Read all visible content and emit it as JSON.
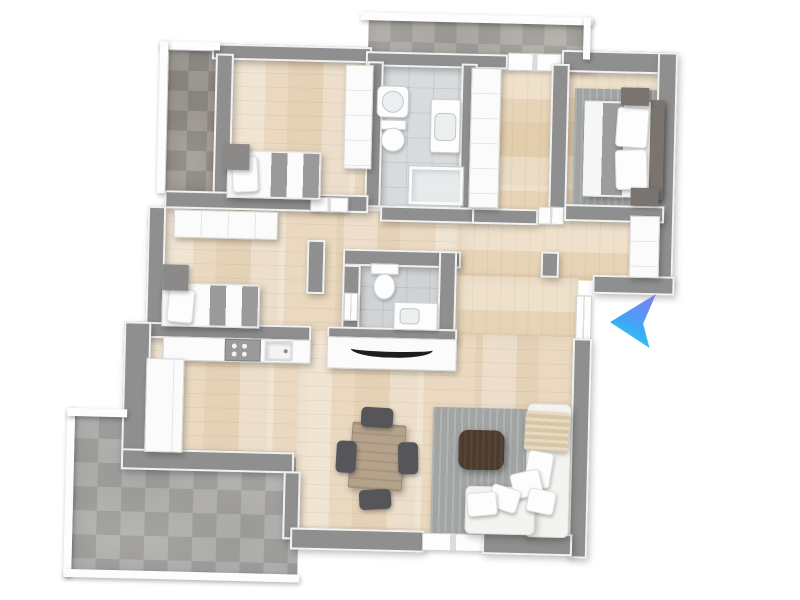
{
  "scene": {
    "type": "floor-plan-3d-top-view-render",
    "rotation_deg": 1.4,
    "rooms": [
      "bedroom-1",
      "bathroom",
      "closet-hall",
      "master-bedroom",
      "corridor",
      "bedroom-2",
      "wc",
      "kitchen",
      "dining-living-room",
      "entry-hall",
      "terrace",
      "balcony-top",
      "balcony-left"
    ],
    "marker": {
      "name": "entrance-arrow",
      "direction": "left",
      "style": "blue-gradient-paper-plane"
    }
  },
  "palette": {
    "bg": "#ffffff",
    "wall": "#8f8f8f",
    "wood": "#ead9c0",
    "wood2": "#e7d4b6",
    "tile": "#d8dbdd",
    "tile2": "#d0d3d5",
    "stone": "#b1b0ae",
    "stonedk": "#a49e98",
    "stonemd": "#b3b0ab",
    "rug": "#a0a4a2",
    "cube": "#8b8a88",
    "tablewood": "#b4a28b",
    "chair": "#56565a",
    "ctable": "#4c3b2e",
    "sofa": "#f4f3f0",
    "blanket": "#d9c6a4",
    "arrow1": "#7a82f2",
    "arrow2": "#41a6f4",
    "arrow3": "#2ad2f1"
  },
  "items": [
    {
      "n": "balcony-top-floor",
      "cls": "stone-md",
      "box": [
        362,
        20,
        215,
        36
      ]
    },
    {
      "n": "balcony-left-floor",
      "cls": "stone-dk",
      "box": [
        163,
        56,
        50,
        142
      ]
    },
    {
      "n": "bedroom1-floor",
      "cls": "wood-h",
      "box": [
        226,
        62,
        142,
        140
      ]
    },
    {
      "n": "bathroom-floor",
      "cls": "tile",
      "box": [
        378,
        62,
        80,
        150
      ]
    },
    {
      "n": "closet-hall-floor",
      "cls": "wood-v",
      "box": [
        466,
        62,
        84,
        150
      ]
    },
    {
      "n": "master-bedroom-floor",
      "cls": "wood-v",
      "box": [
        562,
        60,
        98,
        146
      ]
    },
    {
      "n": "corridor-floor",
      "cls": "wood-h",
      "box": [
        158,
        212,
        306,
        122
      ]
    },
    {
      "n": "wc-floor",
      "cls": "tile-dk",
      "box": [
        360,
        264,
        80,
        68
      ]
    },
    {
      "n": "entry-hall-floor",
      "cls": "wood-v",
      "box": [
        458,
        214,
        202,
        62
      ]
    },
    {
      "n": "entry-hall-floor-south",
      "cls": "wood-v",
      "box": [
        458,
        274,
        120,
        62
      ]
    },
    {
      "n": "terrace-floor",
      "cls": "stone",
      "box": [
        78,
        422,
        226,
        158
      ]
    },
    {
      "n": "kitchen-floor",
      "cls": "wood-h",
      "box": [
        150,
        342,
        162,
        118
      ]
    },
    {
      "n": "living-dining-floor",
      "cls": "wood-h",
      "box": [
        300,
        332,
        280,
        204
      ]
    },
    {
      "n": "master-bedroom-rug",
      "cls": "rug",
      "box": [
        570,
        84,
        82,
        118
      ]
    },
    {
      "n": "living-room-rug",
      "cls": "rug",
      "box": [
        436,
        406,
        140,
        128
      ]
    },
    {
      "n": "wall-bedroom1-north",
      "cls": "wall",
      "box": [
        206,
        48,
        160,
        16
      ]
    },
    {
      "n": "wall-balcony-south-west",
      "cls": "wall",
      "box": [
        360,
        52,
        142,
        15
      ]
    },
    {
      "n": "balcony-door",
      "cls": "door",
      "box": [
        502,
        50,
        54,
        18
      ]
    },
    {
      "n": "wall-balcony-south-east",
      "cls": "wall",
      "box": [
        556,
        50,
        30,
        16
      ]
    },
    {
      "n": "wall-master-north",
      "cls": "wall",
      "box": [
        556,
        46,
        106,
        22
      ]
    },
    {
      "n": "wall-master-east",
      "cls": "wall",
      "box": [
        652,
        46,
        20,
        230
      ]
    },
    {
      "n": "wall-balcony-left-east",
      "cls": "wall",
      "box": [
        210,
        58,
        18,
        142
      ]
    },
    {
      "n": "wall-bathroom-west",
      "cls": "wall",
      "box": [
        362,
        62,
        16,
        146
      ]
    },
    {
      "n": "wall-bathroom-east",
      "cls": "wall",
      "box": [
        456,
        62,
        16,
        150
      ]
    },
    {
      "n": "wall-master-west",
      "cls": "wall",
      "box": [
        546,
        60,
        18,
        148
      ]
    },
    {
      "n": "wall-corridor-north",
      "cls": "wall",
      "box": [
        162,
        196,
        204,
        18
      ]
    },
    {
      "n": "bedroom1-door",
      "cls": "door",
      "box": [
        308,
        199,
        38,
        15
      ]
    },
    {
      "n": "wall-bathroom-south",
      "cls": "wall",
      "box": [
        378,
        206,
        94,
        16
      ]
    },
    {
      "n": "wall-hall-south",
      "cls": "wall",
      "box": [
        470,
        206,
        66,
        16
      ]
    },
    {
      "n": "master-door",
      "cls": "door",
      "box": [
        536,
        203,
        26,
        18
      ]
    },
    {
      "n": "wall-master-south",
      "cls": "wall",
      "box": [
        562,
        200,
        100,
        17
      ]
    },
    {
      "n": "wall-bedroom2-west",
      "cls": "wall",
      "box": [
        146,
        212,
        18,
        122
      ]
    },
    {
      "n": "wall-bedroom2-east",
      "cls": "wall",
      "box": [
        306,
        242,
        18,
        54
      ]
    },
    {
      "n": "wall-wc-north",
      "cls": "wall",
      "box": [
        342,
        250,
        118,
        17
      ]
    },
    {
      "n": "wall-wc-west",
      "cls": "wall",
      "box": [
        342,
        266,
        18,
        68
      ]
    },
    {
      "n": "wc-door",
      "cls": "door",
      "box": [
        344,
        294,
        14,
        28
      ]
    },
    {
      "n": "wall-wc-east",
      "cls": "wall",
      "box": [
        438,
        250,
        18,
        90
      ]
    },
    {
      "n": "wall-wc-south",
      "cls": "wall",
      "box": [
        328,
        328,
        130,
        12
      ]
    },
    {
      "n": "wall-entry-stub",
      "cls": "wall",
      "box": [
        540,
        248,
        18,
        26
      ]
    },
    {
      "n": "wall-entry-step",
      "cls": "wall",
      "box": [
        592,
        270,
        82,
        19
      ]
    },
    {
      "n": "entry-door",
      "cls": "door",
      "box": [
        576,
        291,
        16,
        44
      ]
    },
    {
      "n": "wall-living-east",
      "cls": "wall",
      "box": [
        574,
        334,
        19,
        220
      ]
    },
    {
      "n": "wall-kitchen-north",
      "cls": "wall",
      "box": [
        148,
        328,
        164,
        16
      ]
    },
    {
      "n": "wall-kitchen-west",
      "cls": "wall",
      "box": [
        125,
        328,
        27,
        132
      ]
    },
    {
      "n": "wall-kitchen-south",
      "cls": "wall",
      "box": [
        125,
        455,
        173,
        21
      ]
    },
    {
      "n": "wall-terrace-stub",
      "cls": "wall",
      "box": [
        288,
        474,
        17,
        68
      ]
    },
    {
      "n": "wall-living-south-west",
      "cls": "wall",
      "box": [
        296,
        530,
        134,
        22
      ]
    },
    {
      "n": "terrace-door",
      "cls": "door",
      "box": [
        428,
        532,
        62,
        18
      ]
    },
    {
      "n": "wall-living-south-east",
      "cls": "wall",
      "box": [
        488,
        530,
        90,
        22
      ]
    },
    {
      "n": "railing-balcony-top",
      "cls": "rail",
      "box": [
        354,
        13,
        232,
        8
      ]
    },
    {
      "n": "railing-balcony-top-end",
      "cls": "rail",
      "box": [
        577,
        13,
        7,
        42
      ]
    },
    {
      "n": "railing-balcony-left-top",
      "cls": "rail",
      "box": [
        154,
        47,
        60,
        8
      ]
    },
    {
      "n": "railing-balcony-left",
      "cls": "rail",
      "box": [
        154,
        47,
        8,
        152
      ]
    },
    {
      "n": "railing-terrace-west",
      "cls": "rail",
      "box": [
        70,
        416,
        8,
        168
      ]
    },
    {
      "n": "railing-terrace-north-west",
      "cls": "rail",
      "box": [
        70,
        416,
        60,
        8
      ]
    },
    {
      "n": "railing-terrace-south",
      "cls": "rail",
      "box": [
        70,
        577,
        236,
        8
      ]
    },
    {
      "n": "bedroom1-wardrobe",
      "cls": "cab seams-h",
      "box": [
        340,
        66,
        28,
        104
      ]
    },
    {
      "n": "hallway-sideboard",
      "cls": "cab seams-v",
      "box": [
        172,
        215,
        104,
        28
      ]
    },
    {
      "n": "closet-wardrobe",
      "cls": "cab seams-h",
      "box": [
        466,
        66,
        30,
        140
      ]
    },
    {
      "n": "entry-wardrobe",
      "cls": "cab seams-h",
      "box": [
        628,
        210,
        30,
        62
      ]
    },
    {
      "n": "bedroom1-bed-frame",
      "cls": "bedframe",
      "box": [
        224,
        154,
        94,
        48
      ]
    },
    {
      "n": "bedroom1-bed-duvet",
      "cls": "duvet",
      "box": [
        252,
        156,
        64,
        44
      ]
    },
    {
      "n": "bedroom1-bed-pillow",
      "cls": "pillow",
      "box": [
        229,
        160,
        26,
        36
      ],
      "rotate": -4
    },
    {
      "n": "bedroom1-bed-headboard",
      "cls": "cube",
      "box": [
        220,
        148,
        26,
        26
      ]
    },
    {
      "n": "bedroom2-bed-frame",
      "cls": "bedframe",
      "box": [
        162,
        288,
        98,
        44
      ]
    },
    {
      "n": "bedroom2-bed-duvet",
      "cls": "duvet",
      "box": [
        194,
        290,
        64,
        40
      ]
    },
    {
      "n": "bedroom2-bed-pillow",
      "cls": "pillow",
      "box": [
        168,
        294,
        26,
        34
      ],
      "rotate": 4
    },
    {
      "n": "bedroom2-bed-headboard",
      "cls": "cube",
      "box": [
        162,
        270,
        26,
        26
      ]
    },
    {
      "n": "master-bed-frame",
      "cls": "bedframe",
      "box": [
        580,
        96,
        78,
        96
      ]
    },
    {
      "n": "master-bed-duvet",
      "cls": "duvet-m",
      "box": [
        580,
        98,
        70,
        92
      ]
    },
    {
      "n": "master-bed-headboard",
      "cls": "cube-dk",
      "box": [
        646,
        94,
        14,
        100
      ]
    },
    {
      "n": "master-bed-pillow-top",
      "cls": "pillow",
      "box": [
        612,
        102,
        32,
        40
      ],
      "rotate": 3
    },
    {
      "n": "master-bed-pillow-bottom",
      "cls": "pillow",
      "box": [
        612,
        144,
        32,
        40
      ],
      "rotate": -3
    },
    {
      "n": "master-nightstand-north",
      "cls": "cube-dk",
      "box": [
        616,
        82,
        28,
        18
      ]
    },
    {
      "n": "master-nightstand-south",
      "cls": "cube-dk",
      "box": [
        628,
        182,
        28,
        18
      ]
    },
    {
      "n": "bathroom-bathtub",
      "cls": "fixture",
      "box": [
        372,
        86,
        32,
        32
      ],
      "radius": "6px"
    },
    {
      "n": "bathroom-bathtub-basin",
      "cls": "basin",
      "box": [
        377,
        91,
        22,
        22
      ],
      "radius": "50%"
    },
    {
      "n": "bathroom-toilet-tank",
      "cls": "fixture",
      "box": [
        376,
        120,
        26,
        10
      ]
    },
    {
      "n": "bathroom-toilet-bowl",
      "cls": "fixture",
      "box": [
        377,
        128,
        24,
        24
      ],
      "radius": "50%"
    },
    {
      "n": "bathroom-vanity",
      "cls": "fixture",
      "box": [
        426,
        98,
        30,
        54
      ],
      "radius": "3px"
    },
    {
      "n": "bathroom-vanity-basin",
      "cls": "basin",
      "box": [
        430,
        112,
        22,
        28
      ],
      "radius": "6px"
    },
    {
      "n": "bathroom-shower",
      "cls": "shower",
      "box": [
        406,
        166,
        54,
        38
      ]
    },
    {
      "n": "wc-toilet-tank",
      "cls": "fixture",
      "box": [
        370,
        264,
        28,
        11
      ]
    },
    {
      "n": "wc-toilet-bowl",
      "cls": "fixture",
      "box": [
        373,
        274,
        22,
        26
      ],
      "radius": "50%"
    },
    {
      "n": "wc-vanity",
      "cls": "fixture",
      "box": [
        394,
        302,
        44,
        28
      ]
    },
    {
      "n": "wc-vanity-basin",
      "cls": "basin",
      "box": [
        400,
        308,
        20,
        16
      ],
      "radius": "4px"
    },
    {
      "n": "kitchen-counter",
      "cls": "cab",
      "box": [
        164,
        342,
        148,
        24
      ]
    },
    {
      "n": "kitchen-cooktop",
      "cls": "cooktop",
      "box": [
        226,
        343,
        36,
        22
      ]
    },
    {
      "n": "kitchen-sink",
      "cls": "sink",
      "box": [
        266,
        344,
        28,
        20
      ]
    },
    {
      "n": "kitchen-counter-column",
      "cls": "cab seams-v",
      "box": [
        148,
        364,
        38,
        94
      ]
    },
    {
      "n": "tv-sideboard",
      "cls": "cab",
      "box": [
        328,
        338,
        130,
        32
      ]
    },
    {
      "n": "tv-screen",
      "cls": "tv",
      "box": [
        352,
        341,
        82,
        17
      ]
    },
    {
      "n": "dining-table",
      "cls": "table-wood",
      "box": [
        354,
        424,
        54,
        66
      ],
      "rotate": 3
    },
    {
      "n": "dining-chair-north",
      "cls": "chair",
      "box": [
        364,
        408,
        32,
        20
      ],
      "rotate": 2
    },
    {
      "n": "dining-chair-south",
      "cls": "chair",
      "box": [
        364,
        490,
        32,
        20
      ],
      "rotate": -4
    },
    {
      "n": "dining-chair-west",
      "cls": "chair",
      "box": [
        340,
        442,
        20,
        32
      ],
      "rotate": 2
    },
    {
      "n": "dining-chair-east",
      "cls": "chair",
      "box": [
        402,
        442,
        20,
        32
      ],
      "rotate": -2
    },
    {
      "n": "coffee-table",
      "cls": "ctable",
      "box": [
        462,
        428,
        46,
        40
      ],
      "radius": "10px"
    },
    {
      "n": "sofa-chaise",
      "cls": "sofa",
      "box": [
        530,
        400,
        44,
        134
      ]
    },
    {
      "n": "sofa-seat",
      "cls": "sofa",
      "box": [
        470,
        484,
        70,
        48
      ]
    },
    {
      "n": "sofa-blanket",
      "cls": "blanket",
      "box": [
        528,
        408,
        44,
        40
      ],
      "rotate": 2
    },
    {
      "n": "sofa-pillow-1",
      "cls": "pillow",
      "box": [
        530,
        448,
        26,
        36
      ],
      "rotate": 8
    },
    {
      "n": "sofa-pillow-2",
      "cls": "pillow",
      "box": [
        516,
        468,
        30,
        26
      ],
      "rotate": -14
    },
    {
      "n": "sofa-pillow-3",
      "cls": "pillow",
      "box": [
        494,
        484,
        30,
        24
      ],
      "rotate": 16
    },
    {
      "n": "sofa-pillow-4",
      "cls": "pillow",
      "box": [
        472,
        490,
        30,
        24
      ],
      "rotate": -6
    },
    {
      "n": "sofa-pillow-5",
      "cls": "pillow",
      "box": [
        532,
        486,
        28,
        24
      ],
      "rotate": 10
    },
    {
      "n": "entrance-arrow",
      "cls": "arrow",
      "box": [
        610,
        294,
        46,
        54
      ],
      "layer": "overlay"
    }
  ]
}
